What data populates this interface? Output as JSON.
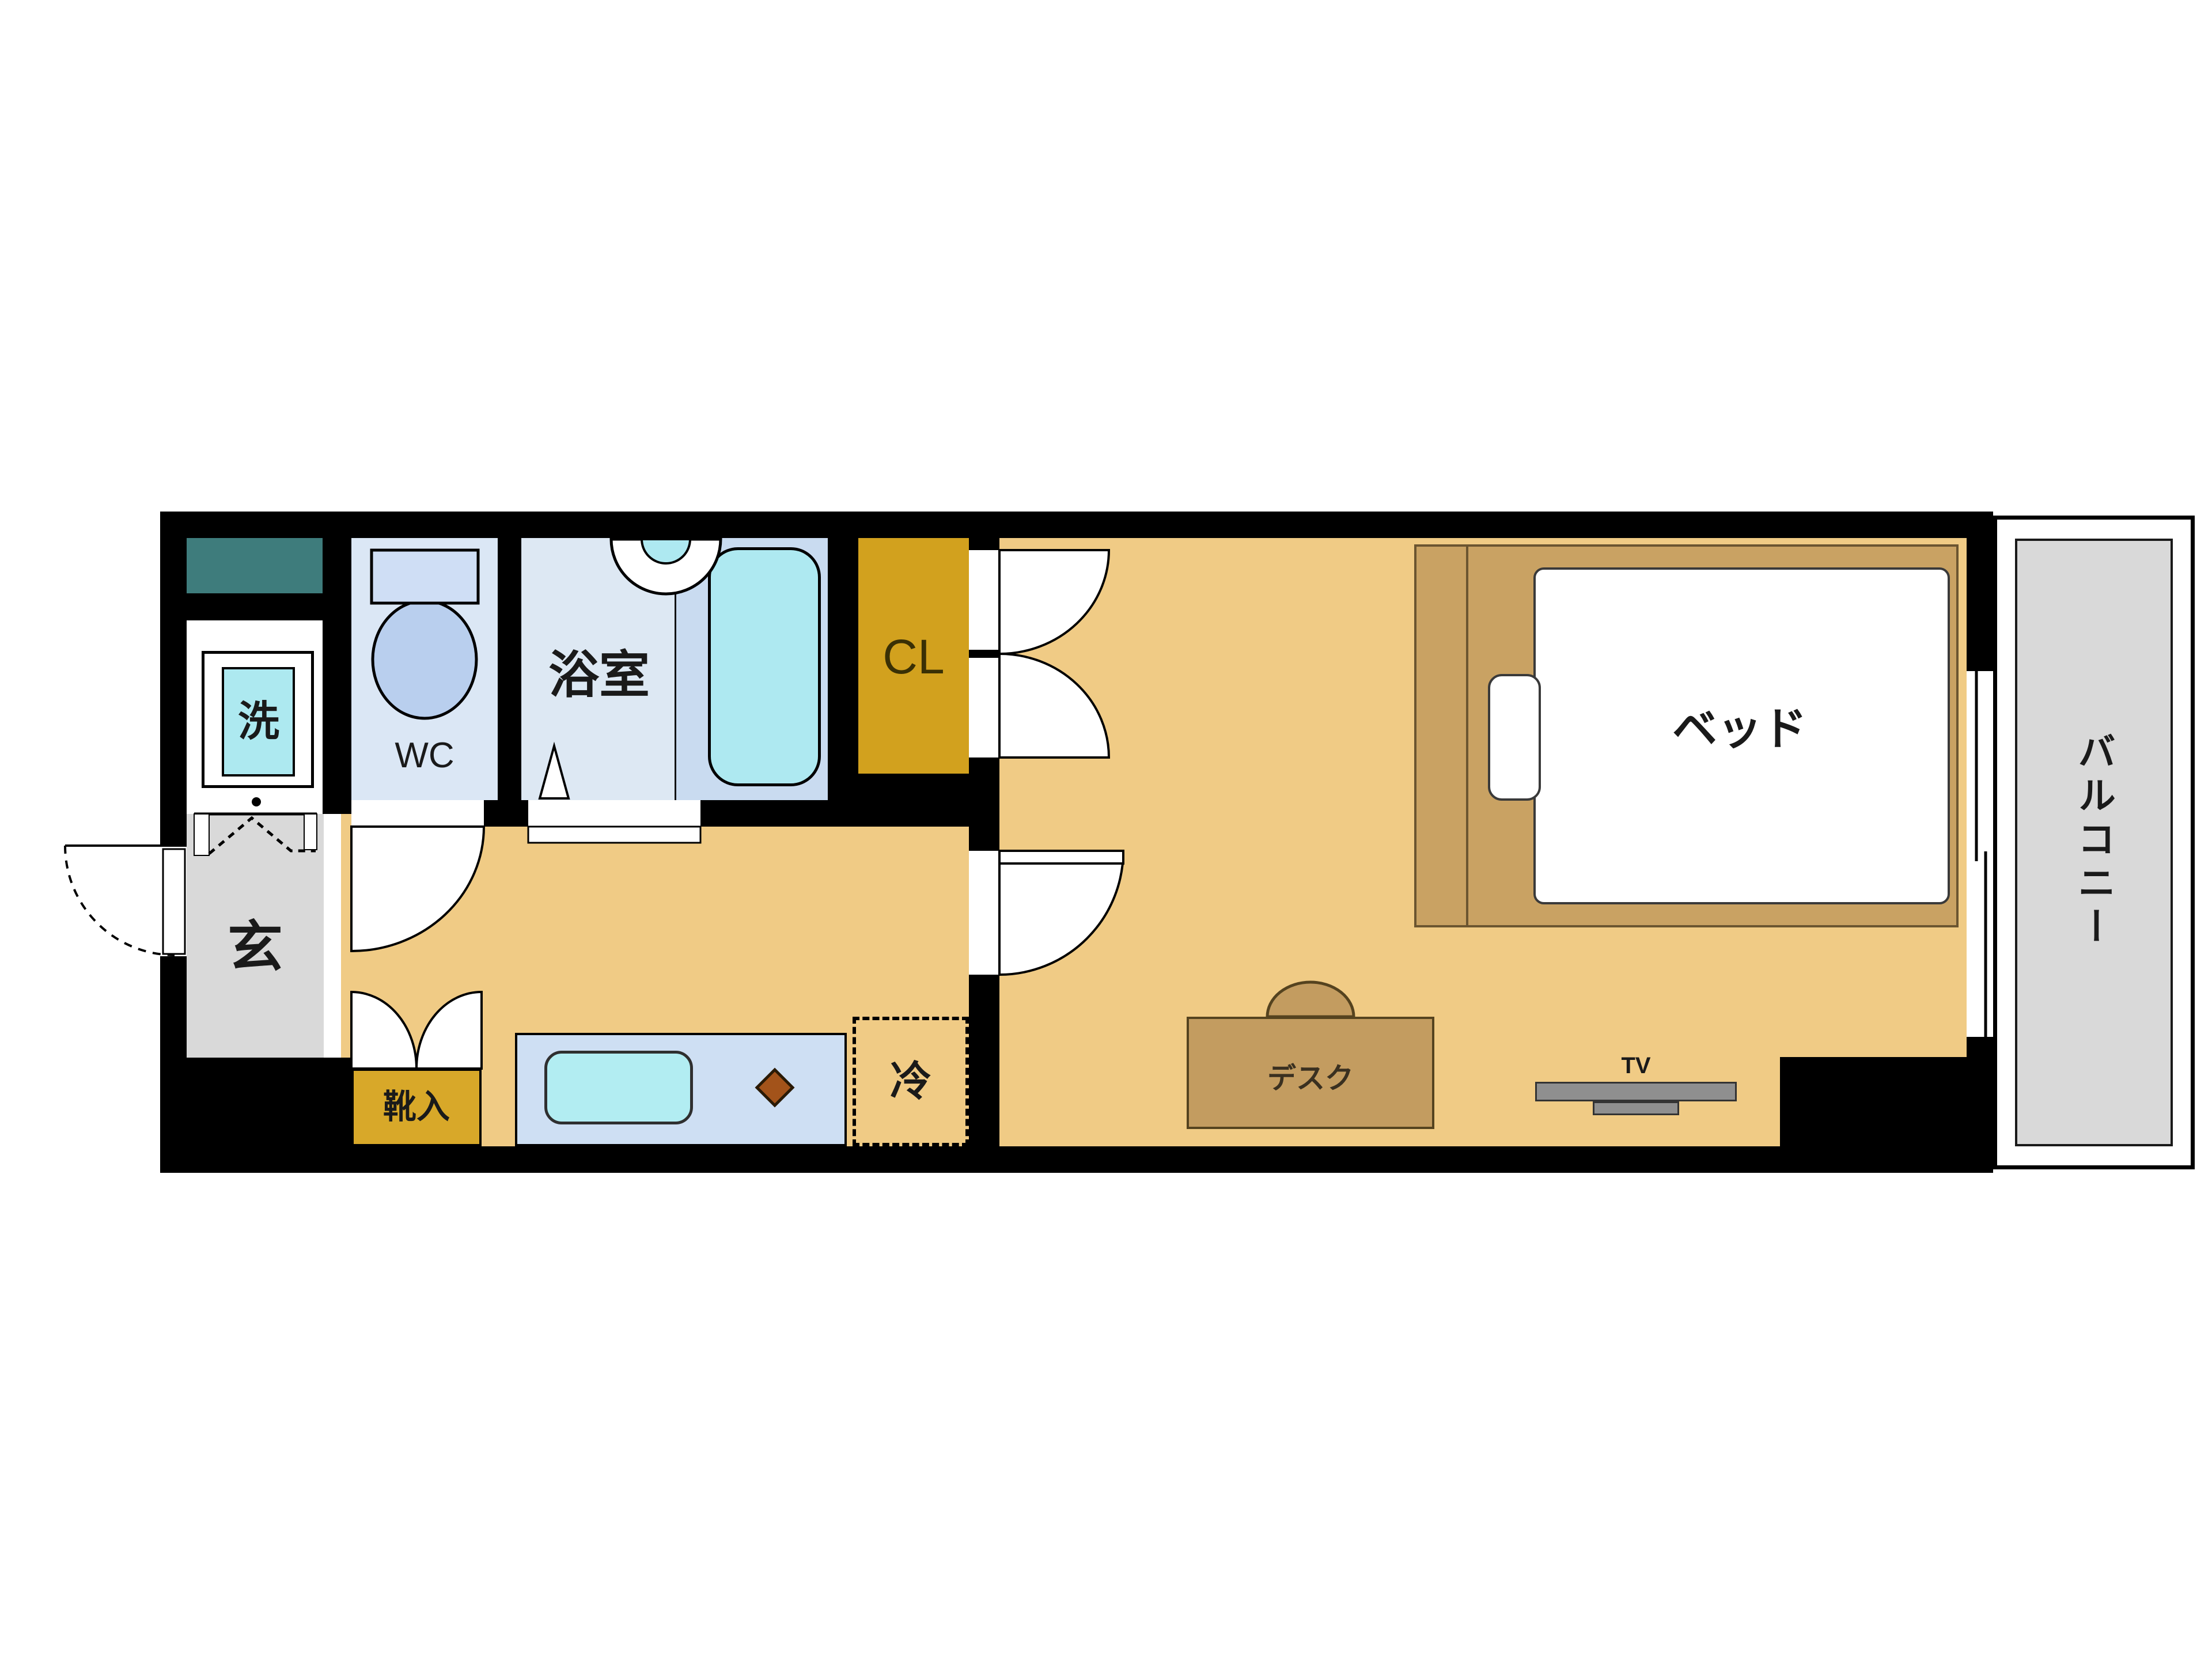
{
  "plan": {
    "type": "apartment-floor-plan",
    "labels": {
      "laundry": "洗",
      "wc": "WC",
      "bath": "浴室",
      "closet": "CL",
      "bed": "ベッド",
      "balcony": "バルコニー",
      "entrance": "玄",
      "shoe_storage": "靴入",
      "refrigerator": "冷",
      "desk": "デスク",
      "tv": "TV"
    },
    "colors": {
      "wall": "#000000",
      "floor_tan": "#f0cb85",
      "wc_room_blue": "#dbe7f5",
      "bath_room_blue": "#dde8f3",
      "tub_zone_blue": "#c9dbf0",
      "water_cyan": "#aee9f1",
      "closet_gold": "#d2a11e",
      "shoe_gold": "#d8a829",
      "entrance_gray": "#d9d9d9",
      "balcony_gray": "#d9d9d9",
      "counter_blue": "#cedff3",
      "teal_counter": "#3e7c7c",
      "bed_frame_tan": "#c9a263",
      "desk_tan": "#c39c60",
      "tv_gray": "#8f8f8f",
      "burner_brown": "#a3531a"
    }
  }
}
